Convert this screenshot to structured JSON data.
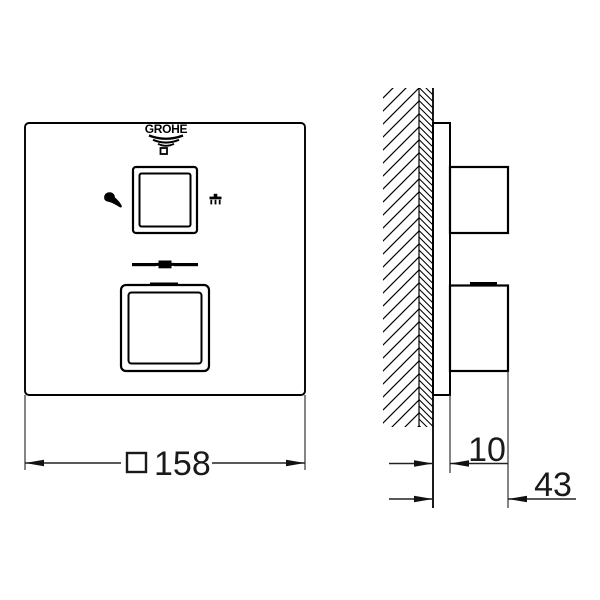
{
  "drawing": {
    "brand_logo_text": "GROHE",
    "dimensions": {
      "front_width": "158",
      "front_width_symbol": "square-outline",
      "projection": "10",
      "depth": "43"
    },
    "icons": {
      "hand_shower": "hand-shower-icon",
      "overhead_shower": "overhead-shower-icon",
      "square_dimension_symbol": "square-symbol-icon",
      "logo_wave_mark": "grohe-wave-icon"
    },
    "colors": {
      "line": "#000000",
      "dimension_line": "#222222",
      "background": "#ffffff"
    }
  }
}
